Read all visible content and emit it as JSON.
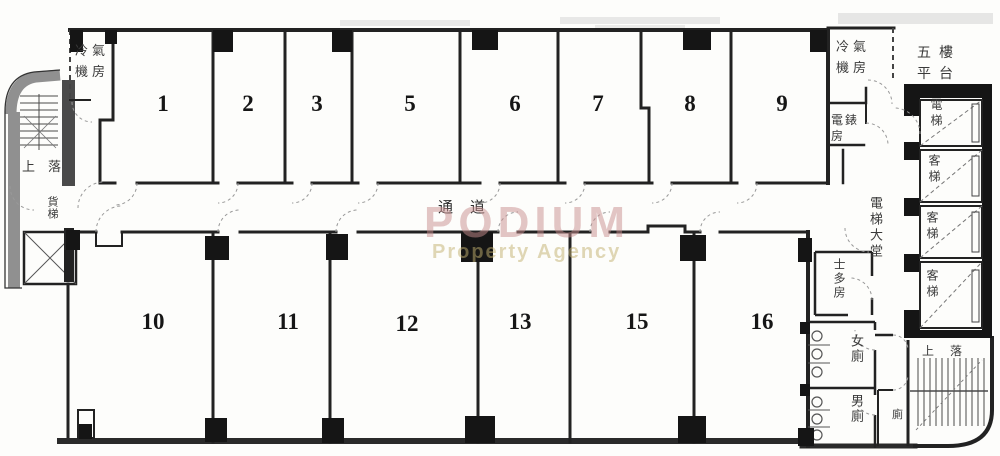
{
  "plan": {
    "corridor_label": "通道",
    "units": [
      "1",
      "2",
      "3",
      "5",
      "6",
      "7",
      "8",
      "9",
      "10",
      "11",
      "12",
      "13",
      "15",
      "16"
    ],
    "rooms": {
      "aircon_left": "冷氣機房",
      "aircon_right": "冷氣機房",
      "platform": "五樓平台",
      "meter_room": "電錶房",
      "lift_lobby": "電梯大堂",
      "store_room": "士多房",
      "female_toilet": "女廁",
      "male_toilet": "男廁",
      "small_toilet": "廁",
      "stairs_left": "上落",
      "stairs_right": "上落",
      "main_lift": "電梯",
      "passenger_lift_1": "客梯",
      "passenger_lift_2": "客梯",
      "passenger_lift_3": "客梯",
      "service_lift": "貨梯"
    }
  },
  "watermark": {
    "brand": "PODIUM",
    "tagline": "Property Agency"
  },
  "colors": {
    "ink": "#222222",
    "pillar_black": "#151515",
    "hatch_gray": "#909090",
    "watermark_brand": "#c98f8f",
    "watermark_tagline": "#c2b070"
  }
}
